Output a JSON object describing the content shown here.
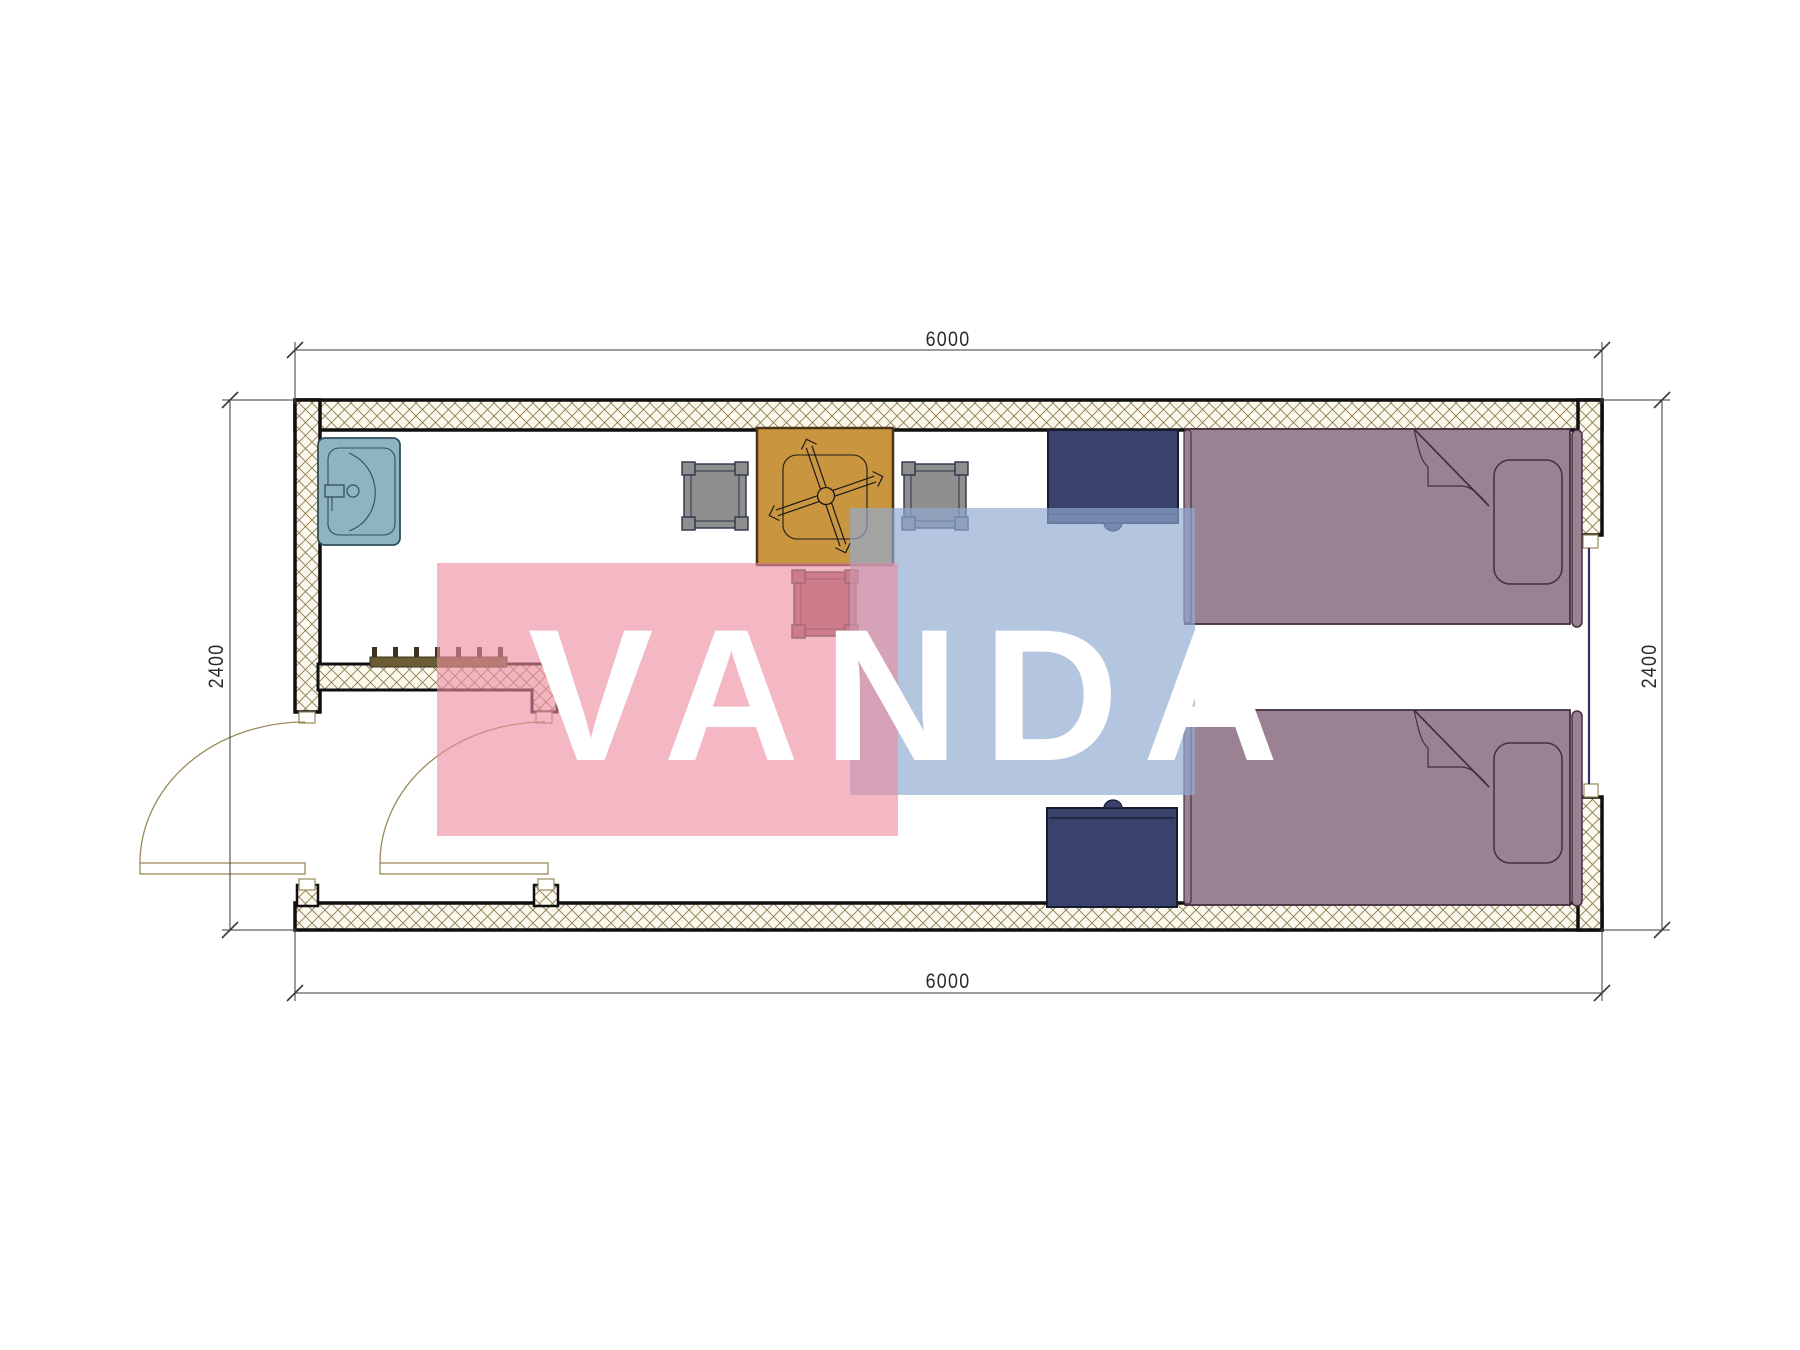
{
  "watermark": {
    "text": "VANDA"
  },
  "dimensions": {
    "top": "6000",
    "bottom": "6000",
    "left": "2400",
    "right": "2400"
  },
  "furniture": [
    "sink",
    "dining-table",
    "chair-gray-left",
    "chair-gray-right",
    "chair-maroon-bottom",
    "bedside-cabinet-top",
    "bedside-cabinet-bottom",
    "single-bed-top",
    "single-bed-bottom",
    "coat-hook-rail",
    "entry-door-left",
    "entry-door-inner",
    "window-right"
  ],
  "colors": {
    "wall-line": "#0f0f0f",
    "hatch-line": "#8d7c52",
    "hatch-bg": "#fbf8ee",
    "cap-line": "#9a8a5a",
    "dim-line": "#3a3a3a",
    "dim-text": "#2a2a2a",
    "door": "#9a8a5a",
    "sink-fill": "#8fb4c0",
    "sink-line": "#2e4f5a",
    "table-fill": "#c9953f",
    "table-line": "#4a3418",
    "cross-line": "#1a1a1a",
    "chair-gray": "#8f8f8f",
    "chair-maroon": "#9d6167",
    "chair-line": "#2a3448",
    "cabinet-fill": "#39426b",
    "cabinet-line": "#161b30",
    "bed-fill": "#9a8292",
    "bed-line": "#43303f",
    "hook-fill": "#6b5c33",
    "hook-line": "#3a3320",
    "window-line": "#2a3560",
    "wm-pink": "rgba(236,140,160,0.62)",
    "wm-blue": "rgba(145,170,210,0.68)",
    "wm-text": "#ffffff"
  }
}
